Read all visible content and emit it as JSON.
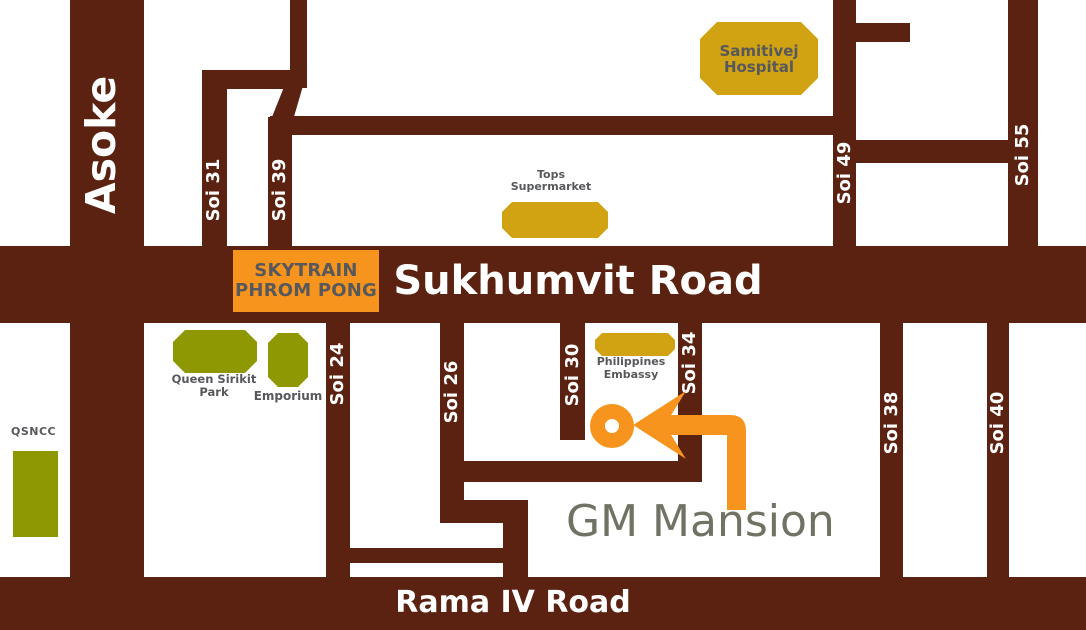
{
  "colors": {
    "road": "#5B2212",
    "orange": "#F7941D",
    "gold": "#D1A313",
    "olive": "#8E9803",
    "label_gray": "#57585B",
    "gm_text": "#707363"
  },
  "main_roads": {
    "sukhumvit": "Sukhumvit Road",
    "rama_iv": "Rama IV Road",
    "asoke": "Asoke"
  },
  "sois": {
    "soi_31": "Soi 31",
    "soi_39": "Soi 39",
    "soi_49": "Soi 49",
    "soi_55": "Soi 55",
    "soi_24": "Soi 24",
    "soi_26": "Soi 26",
    "soi_30": "Soi 30",
    "soi_34": "Soi 34",
    "soi_38": "Soi 38",
    "soi_40": "Soi 40"
  },
  "station": {
    "line1": "SKYTRAIN",
    "line2": "PHROM PONG"
  },
  "landmarks": {
    "samitivej_hospital": {
      "line1": "Samitivej",
      "line2": "Hospital"
    },
    "tops_supermarket": {
      "line1": "Tops",
      "line2": "Supermarket"
    },
    "queen_sirikit_park": {
      "line1": "Queen Sirikit",
      "line2": "Park"
    },
    "emporium": {
      "label": "Emporium"
    },
    "qsncc": {
      "label": "QSNCC"
    },
    "philippines_embassy": {
      "line1": "Philippines",
      "line2": "Embassy"
    }
  },
  "destination": {
    "label": "GM Mansion"
  }
}
